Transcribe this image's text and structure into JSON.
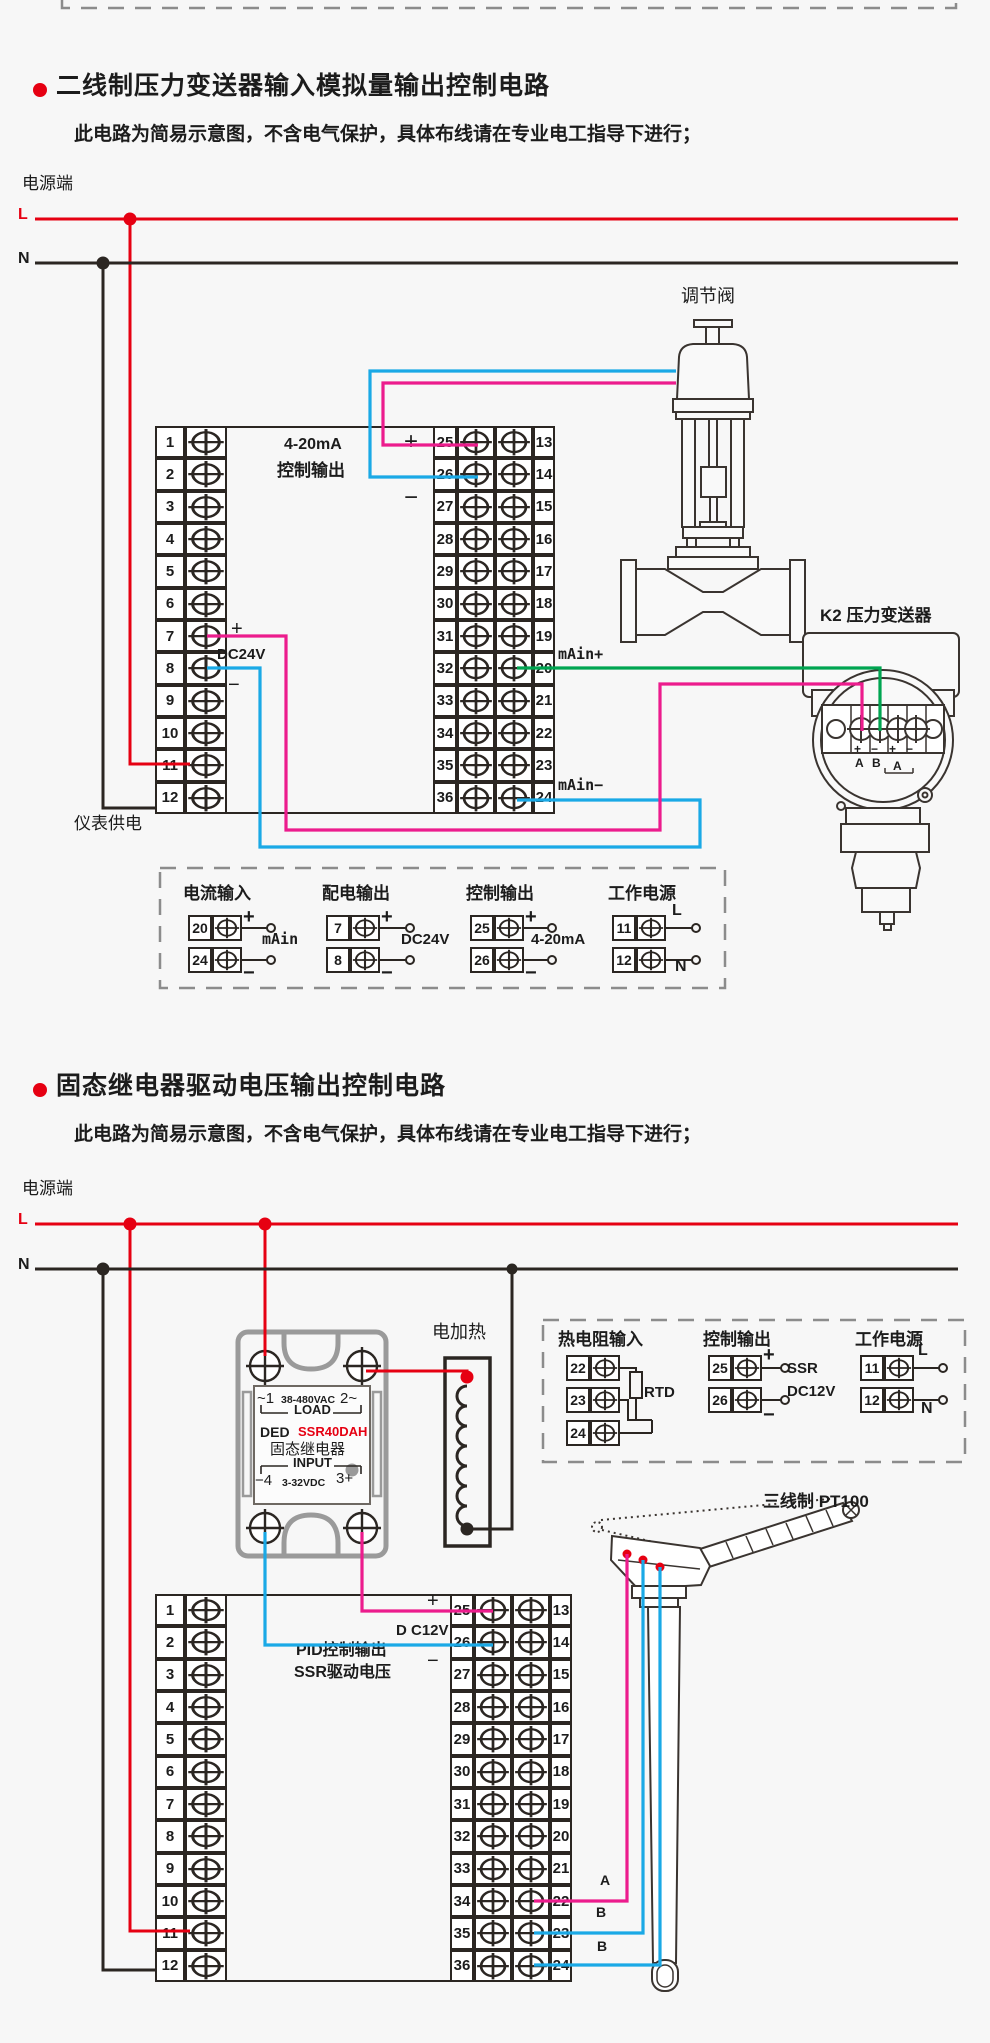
{
  "terminal_numbers": {
    "left": [
      "1",
      "2",
      "3",
      "4",
      "5",
      "6",
      "7",
      "8",
      "9",
      "10",
      "11",
      "12"
    ],
    "mid": [
      "25",
      "26",
      "27",
      "28",
      "29",
      "30",
      "31",
      "32",
      "33",
      "34",
      "35",
      "36"
    ],
    "right": [
      "13",
      "14",
      "15",
      "16",
      "17",
      "18",
      "19",
      "20",
      "21",
      "22",
      "23",
      "24"
    ]
  },
  "section1": {
    "title": "二线制压力变送器输入模拟量输出控制电路",
    "subtitle": "此电路为简易示意图，不含电气保护，具体布线请在专业电工指导下进行；",
    "power": {
      "label": "电源端",
      "l": "L",
      "n": "N"
    },
    "instrument": {
      "output_line1": "4-20mA",
      "output_line2": "控制输出",
      "dc24v_plus": "+",
      "dc24v_label": "DC24V",
      "dc24v_minus": "−",
      "ctrl_plus": "+",
      "ctrl_minus": "−",
      "main_plus": "mAin+",
      "main_minus": "mAin−",
      "supply_label": "仪表供电"
    },
    "valve_label": "调节阀",
    "transmitter": {
      "label": "K2 压力变送器",
      "signs": [
        "+",
        "−",
        "+",
        "−"
      ],
      "letters": [
        "A",
        "B",
        "A"
      ]
    },
    "groups": [
      {
        "title": "电流输入",
        "terminals": [
          "20",
          "24"
        ],
        "signs": [
          "+",
          "−"
        ],
        "label": "mAin"
      },
      {
        "title": "配电输出",
        "terminals": [
          "7",
          "8"
        ],
        "signs": [
          "+",
          "−"
        ],
        "label": "DC24V"
      },
      {
        "title": "控制输出",
        "terminals": [
          "25",
          "26"
        ],
        "signs": [
          "+",
          "−"
        ],
        "label": "4-20mA"
      },
      {
        "title": "工作电源",
        "terminals": [
          "11",
          "12"
        ],
        "signs": [
          "L",
          "N"
        ]
      }
    ]
  },
  "section2": {
    "title": "固态继电器驱动电压输出控制电路",
    "subtitle": "此电路为简易示意图，不含电气保护，具体布线请在专业电工指导下进行；",
    "power": {
      "label": "电源端",
      "l": "L",
      "n": "N"
    },
    "heater_label": "电加热",
    "ssr": {
      "ac_left": "~1",
      "ac_mid": "38-480VAC",
      "ac_right": "2~",
      "load": "LOAD",
      "brand": "DED",
      "model": "SSR40DAH",
      "name": "固态继电器",
      "input": "INPUT",
      "dc_left": "−4",
      "dc_mid": "3-32VDC",
      "dc_right": "3+"
    },
    "instrument": {
      "pid_line1": "PID控制输出",
      "pid_line2": "SSR驱动电压",
      "dc12v_plus": "+",
      "dc12v_label": "D C12V",
      "dc12v_minus": "−"
    },
    "pt100": {
      "label": "三线制 PT100",
      "wires": [
        "A",
        "B",
        "B"
      ]
    },
    "groups": [
      {
        "title": "热电阻输入",
        "terminals": [
          "22",
          "23",
          "24"
        ],
        "label": "RTD"
      },
      {
        "title": "控制输出",
        "terminals": [
          "25",
          "26"
        ],
        "signs": [
          "+",
          "−"
        ],
        "labels": [
          "SSR",
          "DC12V"
        ]
      },
      {
        "title": "工作电源",
        "terminals": [
          "11",
          "12"
        ],
        "signs": [
          "L",
          "N"
        ]
      }
    ]
  },
  "colors": {
    "live_red": "#e60012",
    "neutral_black": "#2b2622",
    "wire_magenta": "#ec1c8d",
    "wire_blue": "#1aa9e6",
    "wire_green": "#00a551",
    "dashed_grey": "#8c8c8c",
    "ssr_grey": "#9a9a9a",
    "model_red": "#e60012"
  }
}
